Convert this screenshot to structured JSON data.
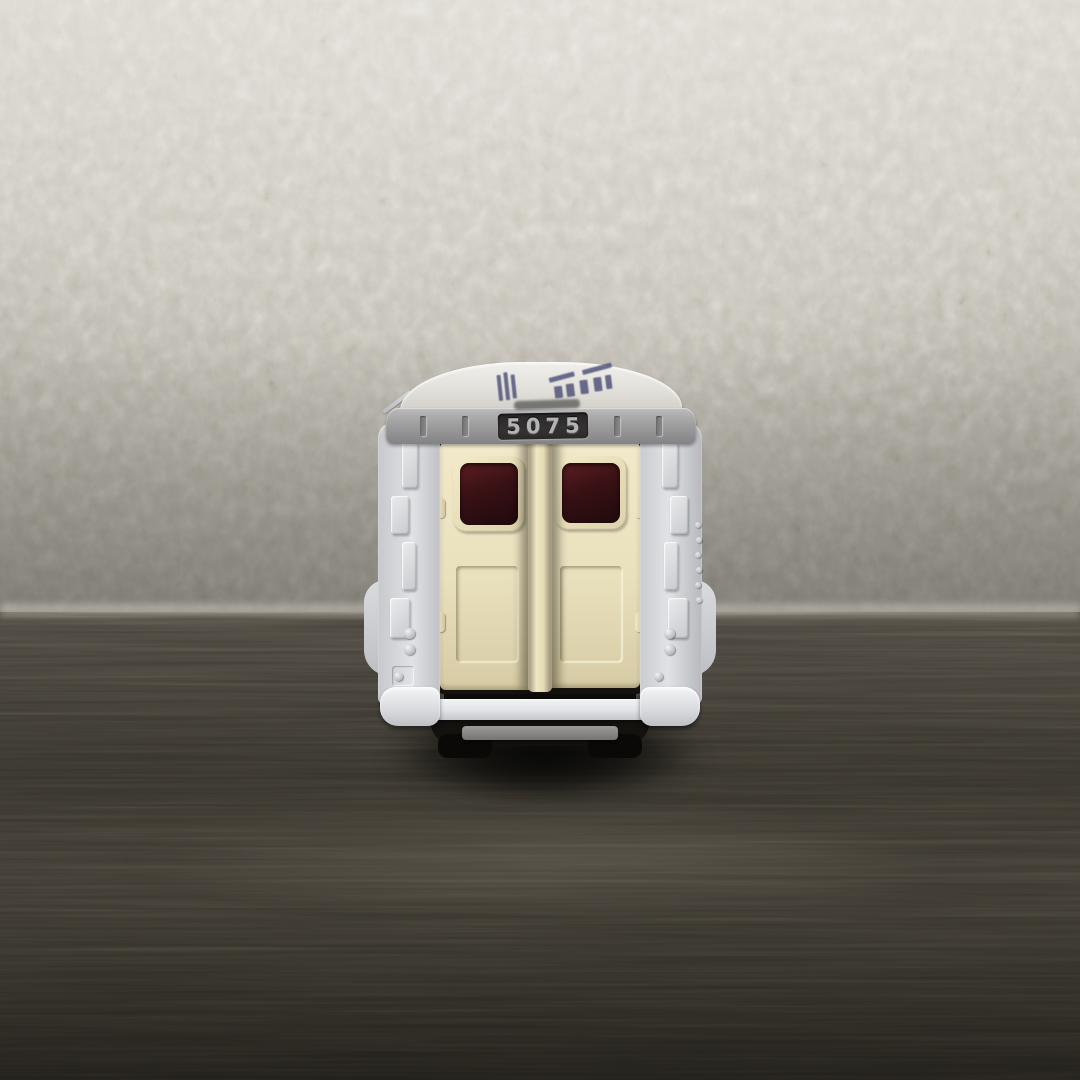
{
  "image_type": "photograph",
  "subject": {
    "description": "Rear view of a small white diecast toy van with cream double rear doors, dark maroon door windows, molded pillar details and a white rear bumper, standing on a dark wood-grain table in front of heavily textured off-white stucco wallpaper",
    "casting_number": "5075",
    "roof_marking": "illegible dark-navy printed lettering on the roof, foreshortened",
    "band_marking": "small illegible embossed text above the casting number"
  },
  "colors": {
    "wall_base": "#c8c4bb",
    "wall_light": "#d8d4cb",
    "wall_shadow": "#aeaaa0",
    "table_top": "#4b4740",
    "table_mid": "#36332c",
    "table_bottom": "#211f1a",
    "body_white": "#e0e2e5",
    "roof_white": "#e3e1db",
    "band_gray": "#a09fa0",
    "band_recess": "#343232",
    "door_cream": "#e9e0bd",
    "door_shade": "#d6cba4",
    "window_maroon": "#371114",
    "window_red": "#5c1d21",
    "print_navy": "#4b5076",
    "bumper_white": "#e0e2e5",
    "plate_gray": "#9b9a98",
    "chassis_black": "#14120e"
  }
}
